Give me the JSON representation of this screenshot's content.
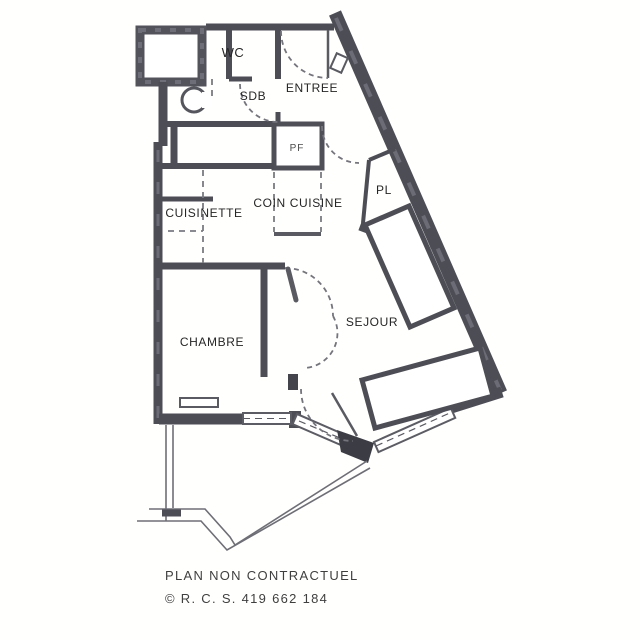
{
  "plan": {
    "rooms": {
      "wc": "WC",
      "sdb": "SDB",
      "entree": "ENTREE",
      "pf": "PF",
      "coin_cuisine": "COIN CUISINE",
      "pl": "PL",
      "cuisinette": "CUISINETTE",
      "chambre": "CHAMBRE",
      "sejour": "SEJOUR"
    },
    "footer": {
      "disclaimer": "PLAN NON CONTRACTUEL",
      "registration": "© R. C. S. 419 662 184"
    },
    "colors": {
      "wall": "#4d4d56",
      "window": "#5c5c64",
      "dashed_line": "#7a7a82",
      "text": "#262626",
      "paper": "#ffffff"
    }
  }
}
